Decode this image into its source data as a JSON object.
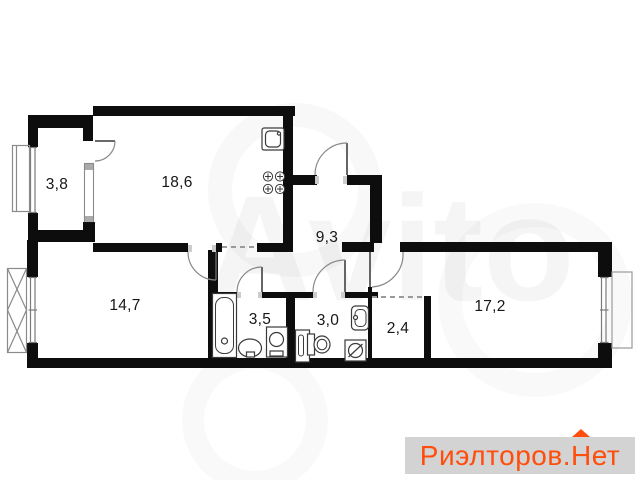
{
  "canvas": {
    "width": 635,
    "height": 480
  },
  "plan": {
    "rooms": [
      {
        "name": "entry-hall",
        "area_label": "3,8"
      },
      {
        "name": "kitchen",
        "area_label": "18,6"
      },
      {
        "name": "hallway",
        "area_label": "9,3"
      },
      {
        "name": "bedroom",
        "area_label": "14,7"
      },
      {
        "name": "bathroom",
        "area_label": "3,5"
      },
      {
        "name": "toilet",
        "area_label": "3,0"
      },
      {
        "name": "wardrobe",
        "area_label": "2,4"
      },
      {
        "name": "living-room",
        "area_label": "17,2"
      }
    ],
    "fixtures": [
      "kitchen-sink-icon",
      "stove-icon",
      "bathtub-icon",
      "washbasin-icon",
      "pedestal-sink-icon",
      "cabinet-icon",
      "toilet-icon",
      "wall-sink-icon",
      "washing-machine-icon"
    ]
  },
  "watermarks": {
    "center": "Avito",
    "corner": {
      "part1": "Риэлторов.",
      "part2": "Н",
      "part3": "ет"
    }
  },
  "colors": {
    "wall": "#0d0d0d",
    "thin_line": "#8a8a8a",
    "accent": "#ff4e0c",
    "badge_bg": "#d3d3d3",
    "label_text": "#161616"
  }
}
